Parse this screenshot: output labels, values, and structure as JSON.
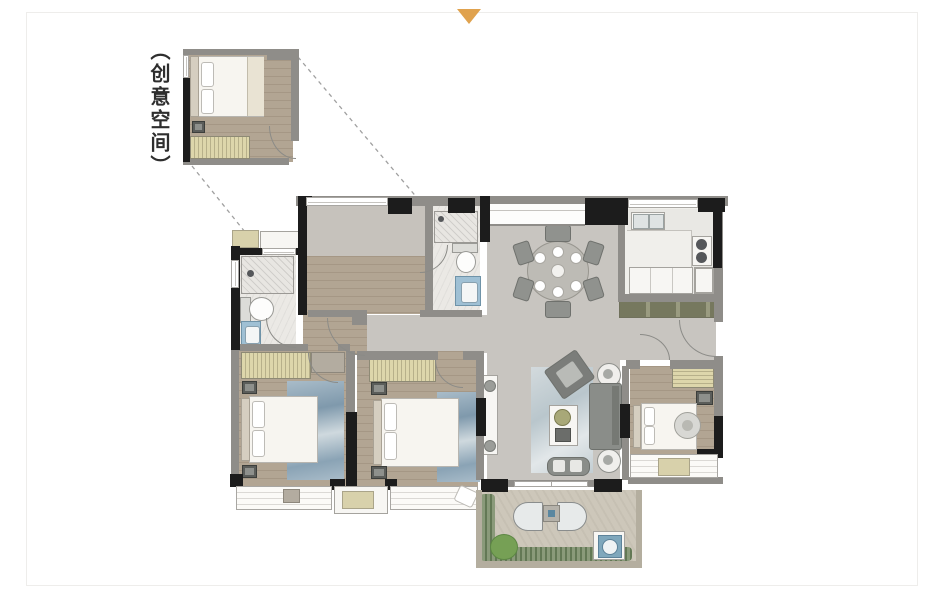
{
  "annotation": {
    "label": "（创意空间）"
  },
  "marker": {
    "type": "triangle-down",
    "color": "#e0a24e"
  },
  "palette": {
    "background": "#ffffff",
    "wall_black": "#1c1c1c",
    "wall_gray": "#8f8d89",
    "tile_gray": "#c8c5c0",
    "wood_floor": "#b2a593",
    "marble_floor": "#ebe9e5",
    "kitchen_floor": "#f0efeb",
    "balcony_floor": "#cdc7ba",
    "rug_blue": "#8ba4b6",
    "vanity_blue": "#9fc0d4",
    "wardrobe_stripe": "#d9d2a8",
    "sideboard_green": "#9a9b80",
    "plant_green": "#76a055",
    "leader_line": "#a0a0a0"
  }
}
